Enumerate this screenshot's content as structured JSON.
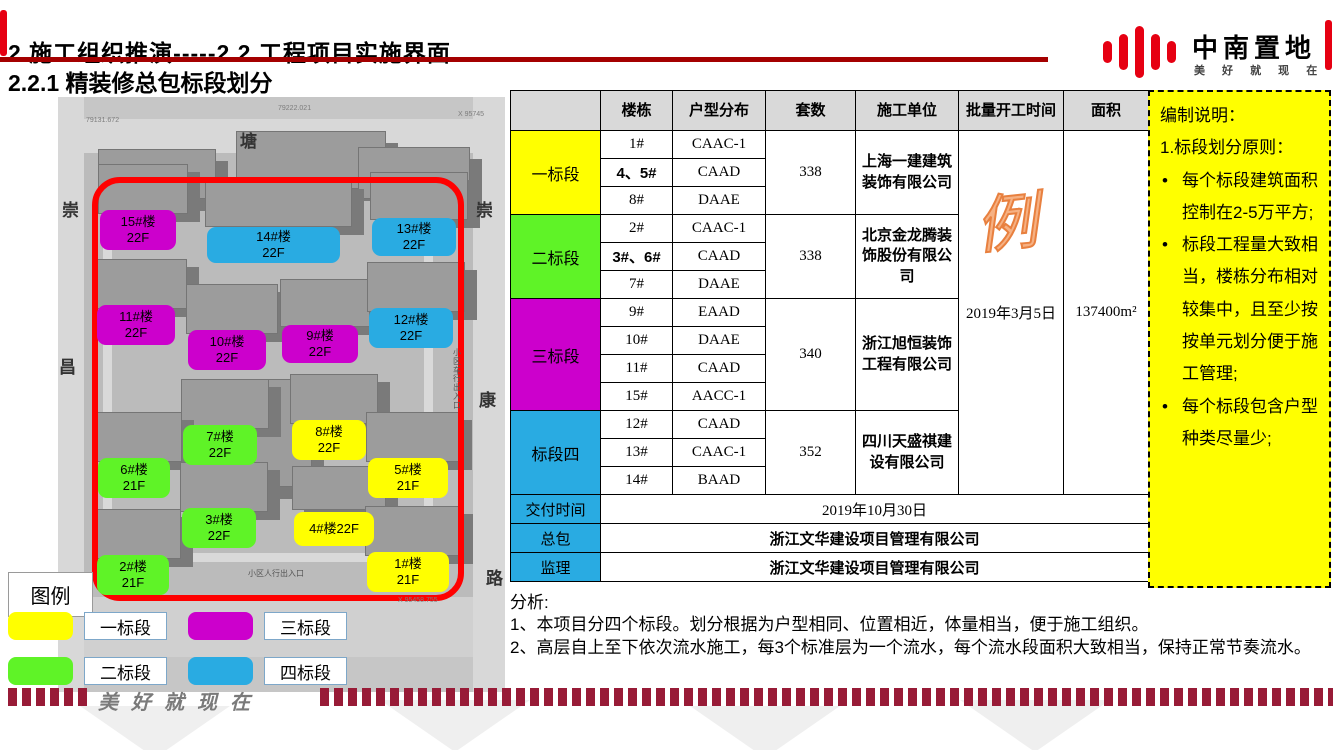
{
  "header": {
    "title": "2 施工组织推演-----2.2 工程项目实施界面",
    "subtitle": "2.2.1 精装修总包标段划分",
    "logo": {
      "name": "中南置地",
      "tagline": "美 好 就 现 在"
    }
  },
  "map": {
    "road_labels": [
      "塘",
      "崇",
      "昌",
      "崇",
      "康",
      "路"
    ],
    "entrance_pedestrian": "小区人行出入口",
    "entrance_vehicle": "小区车行出入口",
    "coord_labels": [
      "79222.021",
      "79131.672",
      "X 95745",
      "X 95458.755"
    ],
    "buildings": [
      {
        "line1": "15#楼",
        "line2": "22F",
        "segment": 3
      },
      {
        "line1": "14#楼",
        "line2": "22F",
        "segment": 4
      },
      {
        "line1": "13#楼",
        "line2": "22F",
        "segment": 4
      },
      {
        "line1": "11#楼",
        "line2": "22F",
        "segment": 3
      },
      {
        "line1": "10#楼",
        "line2": "22F",
        "segment": 3
      },
      {
        "line1": "9#楼",
        "line2": "22F",
        "segment": 3
      },
      {
        "line1": "12#楼",
        "line2": "22F",
        "segment": 4
      },
      {
        "line1": "7#楼",
        "line2": "22F",
        "segment": 2
      },
      {
        "line1": "8#楼",
        "line2": "22F",
        "segment": 1
      },
      {
        "line1": "6#楼",
        "line2": "21F",
        "segment": 2
      },
      {
        "line1": "5#楼",
        "line2": "21F",
        "segment": 1
      },
      {
        "line1": "3#楼",
        "line2": "22F",
        "segment": 2
      },
      {
        "line1": "4#楼22F",
        "line2": "",
        "segment": 1
      },
      {
        "line1": "2#楼",
        "line2": "21F",
        "segment": 2
      },
      {
        "line1": "1#楼",
        "line2": "21F",
        "segment": 1
      }
    ]
  },
  "segment_colors": {
    "1": "#FFFF00",
    "2": "#5FF327",
    "3": "#CC00CC",
    "4": "#29ABE2"
  },
  "table": {
    "headers": [
      "",
      "楼栋",
      "户型分布",
      "套数",
      "施工单位",
      "批量开工时间",
      "面积"
    ],
    "sections": [
      {
        "name": "一标段",
        "color": "#FFFF00",
        "rows": [
          [
            "1#",
            "CAAC-1"
          ],
          [
            "4、5#",
            "CAAD"
          ],
          [
            "8#",
            "DAAE"
          ]
        ],
        "units": "338",
        "contractor": "上海一建建筑装饰有限公司"
      },
      {
        "name": "二标段",
        "color": "#5FF327",
        "rows": [
          [
            "2#",
            "CAAC-1"
          ],
          [
            "3#、6#",
            "CAAD"
          ],
          [
            "7#",
            "DAAE"
          ]
        ],
        "units": "338",
        "contractor": "北京金龙腾装饰股份有限公司"
      },
      {
        "name": "三标段",
        "color": "#CC00CC",
        "rows": [
          [
            "9#",
            "EAAD"
          ],
          [
            "10#",
            "DAAE"
          ],
          [
            "11#",
            "CAAD"
          ],
          [
            "15#",
            "AACC-1"
          ]
        ],
        "units": "340",
        "contractor": "浙江旭恒装饰工程有限公司"
      },
      {
        "name": "标段四",
        "color": "#29ABE2",
        "rows": [
          [
            "12#",
            "CAAD"
          ],
          [
            "13#",
            "CAAC-1"
          ],
          [
            "14#",
            "BAAD"
          ]
        ],
        "units": "352",
        "contractor": "四川天盛祺建设有限公司"
      }
    ],
    "start_time": "2019年3月5日",
    "start_time_watermark": "例",
    "area": "137400m²",
    "footer_rows": [
      {
        "label": "交付时间",
        "value": "2019年10月30日",
        "bold": false
      },
      {
        "label": "总包",
        "value": "浙江文华建设项目管理有限公司",
        "bold": true
      },
      {
        "label": "监理",
        "value": "浙江文华建设项目管理有限公司",
        "bold": true
      }
    ]
  },
  "notes": {
    "title": "编制说明：",
    "line1": "1.标段划分原则：",
    "bullets": [
      "每个标段建筑面积控制在2-5万平方;",
      "标段工程量大致相当，楼栋分布相对较集中，且至少按按单元划分便于施工管理;",
      "每个标段包含户型种类尽量少;"
    ]
  },
  "analysis": {
    "title": "分析:",
    "lines": [
      "1、本项目分四个标段。划分根据为户型相同、位置相近，体量相当，便于施工组织。",
      "2、高层自上至下依次流水施工，每3个标准层为一个流水，每个流水段面积大致相当，保持正常节奏流水。"
    ]
  },
  "legend": {
    "title": "图例",
    "items": [
      {
        "label": "一标段",
        "segment": 1
      },
      {
        "label": "三标段",
        "segment": 3
      },
      {
        "label": "二标段",
        "segment": 2
      },
      {
        "label": "四标段",
        "segment": 4
      }
    ]
  },
  "footer": {
    "script": "美好就现在"
  }
}
